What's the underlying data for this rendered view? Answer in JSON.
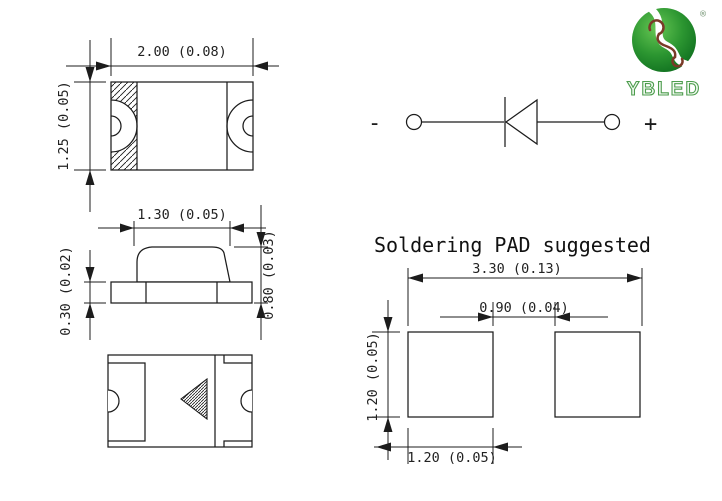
{
  "title": {
    "text": "Soldering PAD suggested"
  },
  "views": {
    "top": {
      "width_label": "2.00 (0.08)",
      "height_label": "1.25 (0.05)"
    },
    "side": {
      "width_label": "1.30 (0.05)",
      "base_height_label": "0.30 (0.02)",
      "total_height_label": "0.80 (0.03)"
    },
    "pad": {
      "overall_width_label": "3.30 (0.13)",
      "gap_label": "0.90 (0.04)",
      "pad_height_label": "1.20 (0.05)",
      "pad_width_label": "1.20 (0.05)"
    }
  },
  "symbol": {
    "minus": "-",
    "plus": "+"
  },
  "logo": {
    "brand": "YBLED",
    "registered": "®"
  },
  "colors": {
    "line": "#1c1c1c",
    "logo_green_dark": "#0f6f1f",
    "logo_green_light": "#66c653",
    "logo_swirl_brown": "#7a3b28",
    "background": "#ffffff"
  }
}
